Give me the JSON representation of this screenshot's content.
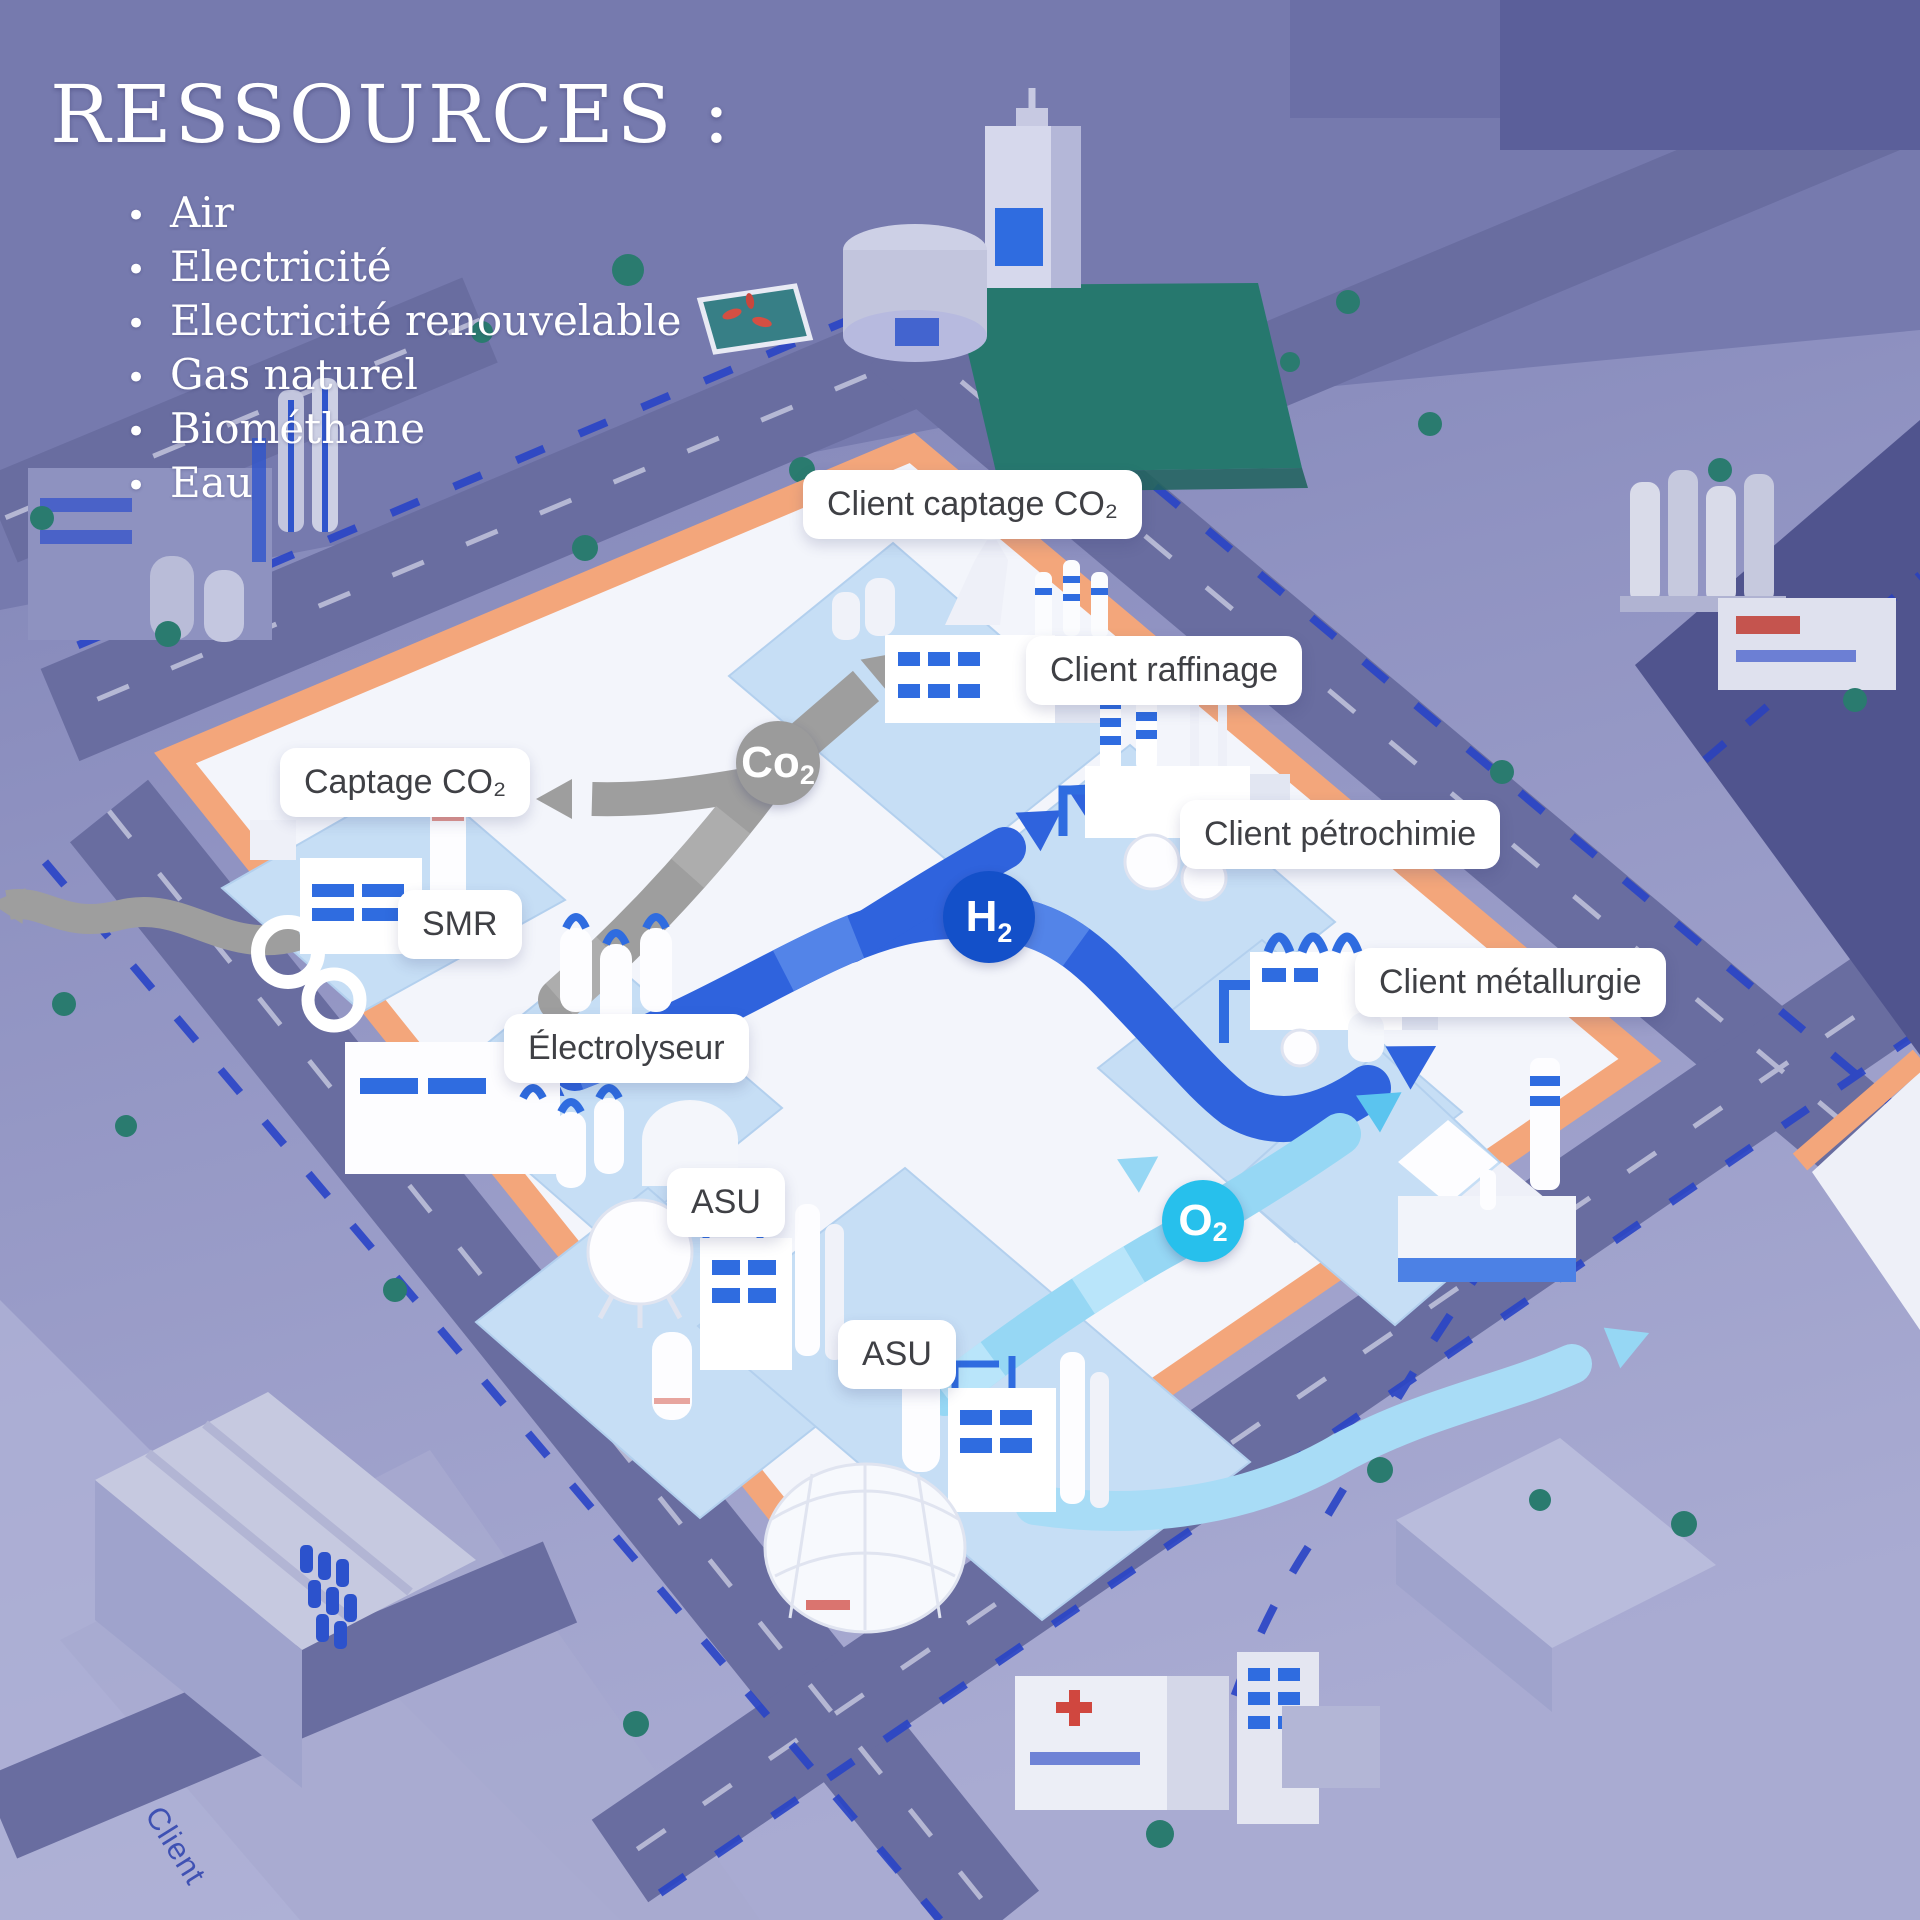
{
  "title": "RESSOURCES :",
  "resources": {
    "items": [
      "Air",
      "Electricité",
      "Electricité renouvelable",
      "Gas naturel",
      "Biométhane",
      "Eau"
    ]
  },
  "map_labels": {
    "client_captage_co2": "Client captage CO₂",
    "client_raffinage": "Client raffinage",
    "captage_co2": "Captage CO₂",
    "client_petrochimie": "Client pétrochimie",
    "smr": "SMR",
    "client_metallurgie": "Client métallurgie",
    "electrolyseur": "Électrolyseur",
    "asu_north": "ASU",
    "asu_south": "ASU"
  },
  "badges": {
    "co2": {
      "symbol": "Co",
      "sub": "2",
      "color": "#9b9b9b"
    },
    "h2": {
      "symbol": "H",
      "sub": "2",
      "color": "#1350c9"
    },
    "o2": {
      "symbol": "O",
      "sub": "2",
      "color": "#27c0ec"
    }
  },
  "street_label": "Client",
  "colors": {
    "background": "#8f92c1",
    "platform": "#f3f5fb",
    "platform_rim": "#f3a67b",
    "parcel": "#c6def5",
    "co2_flow": "#9e9e9e",
    "h2_flow": "#2f63dd",
    "o2_flow": "#96d7f4",
    "park": "#26786e",
    "road": "#696da0"
  }
}
